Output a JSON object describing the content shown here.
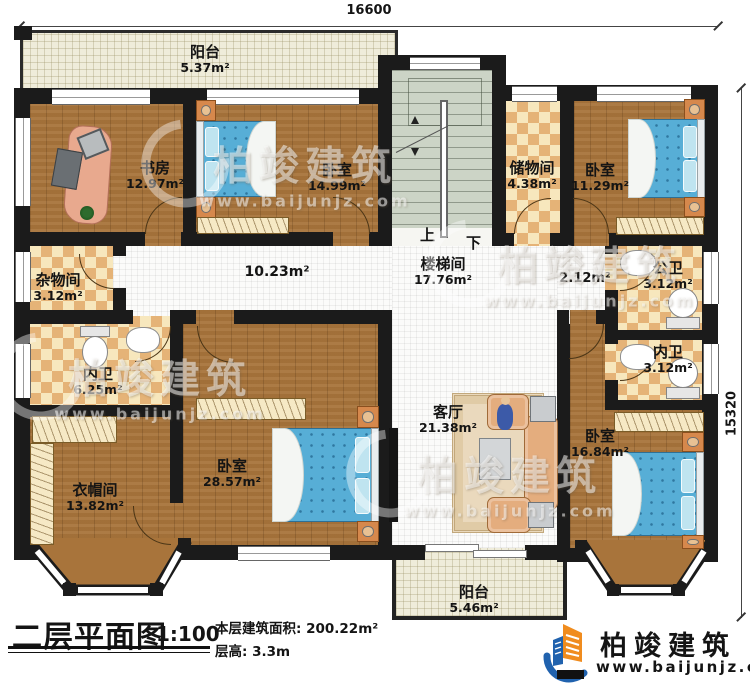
{
  "dimensions": {
    "top": "16600",
    "right": "15320"
  },
  "stairs": {
    "up": "上",
    "down": "下"
  },
  "rooms": {
    "balcony_top": {
      "name": "阳台",
      "area": "5.37m²"
    },
    "study": {
      "name": "书房",
      "area": "12.97m²"
    },
    "bedroom_top": {
      "name": "卧室",
      "area": "14.99m²"
    },
    "storage": {
      "name": "储物间",
      "area": "4.38m²"
    },
    "bedroom_topright": {
      "name": "卧室",
      "area": "11.29m²"
    },
    "utility": {
      "name": "杂物间",
      "area": "3.12m²"
    },
    "hallway": {
      "area": "10.23m²"
    },
    "stairwell": {
      "name": "楼梯间",
      "area": "17.76m²"
    },
    "hall_small": {
      "area": "2.12m²"
    },
    "public_bath": {
      "name": "公卫",
      "area": "3.12m²"
    },
    "inner_bath_right": {
      "name": "内卫",
      "area": "3.12m²"
    },
    "inner_bath_left": {
      "name": "内卫",
      "area": "6.25m²"
    },
    "living": {
      "name": "客厅",
      "area": "21.38m²"
    },
    "bedroom_master": {
      "name": "卧室",
      "area": "28.57m²"
    },
    "cloakroom": {
      "name": "衣帽间",
      "area": "13.82m²"
    },
    "bedroom_bottomright": {
      "name": "卧室",
      "area": "16.84m²"
    },
    "balcony_bottom": {
      "name": "阳台",
      "area": "5.46m²"
    }
  },
  "title": {
    "text": "二层平面图",
    "scale": "1:100"
  },
  "info": {
    "area_label": "本层建筑面积:",
    "area_value": "200.22m²",
    "height_label": "层高:",
    "height_value": "3.3m"
  },
  "brand": {
    "name": "柏竣建筑",
    "url": "www.baijunjz.com"
  },
  "watermark": {
    "name": "柏竣建筑",
    "url": "www.baijunjz.com"
  }
}
